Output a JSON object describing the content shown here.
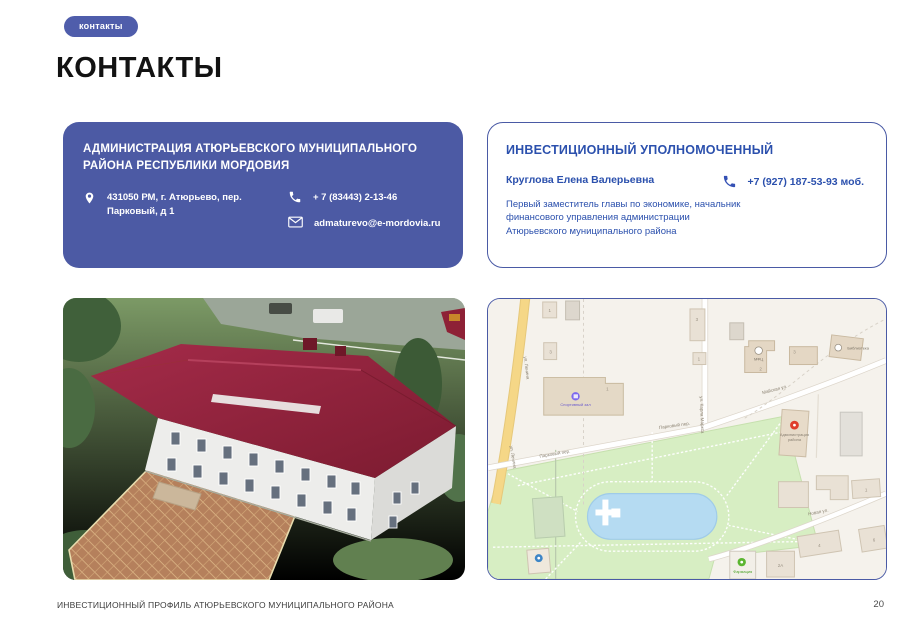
{
  "slide": {
    "badge_label": "контакты",
    "title": "КОНТАКТЫ",
    "footer_text": "ИНВЕСТИЦИОННЫЙ ПРОФИЛЬ АТЮРЬЕВСКОГО МУНИЦИПАЛЬНОГО РАЙОНА",
    "page_number": "20"
  },
  "admin_card": {
    "title": "АДМИНИСТРАЦИЯ АТЮРЬЕВСКОГО МУНИЦИПАЛЬНОГО РАЙОНА РЕСПУБЛИКИ МОРДОВИЯ",
    "address": "431050 РМ, г. Атюрьево, пер. Парковый, д 1",
    "phone": "+ 7 (83443) 2-13-46",
    "email": "admaturevo@e-mordovia.ru"
  },
  "investment_card": {
    "title": "ИНВЕСТИЦИОННЫЙ УПОЛНОМОЧЕННЫЙ",
    "name": "Круглова Елена Валерьевна",
    "phone": "+7 (927) 187-53-93 моб.",
    "position": "Первый заместитель главы по экономике, начальник финансового управления администрации Атюрьевского муниципального района"
  },
  "map": {
    "street_lenina": "ул. Ленина",
    "street_karla_marksa": "ул. Карла Маркса",
    "street_parkovy": "Парковый пер.",
    "street_mayskaya": "Майская ул.",
    "street_novaya": "Новая ул.",
    "poi_sport": "Спортивный зал",
    "poi_mfc": "МФЦ",
    "poi_library": "Библиотека",
    "poi_admin_line1": "Администрация",
    "poi_admin_line2": "района",
    "poi_pharmacy": "Фармация",
    "numbers": {
      "n1": "1",
      "n2": "2",
      "n3": "3",
      "n4": "4",
      "n6": "6",
      "n2a": "2А"
    }
  },
  "colors": {
    "accent_blue": "#4c5aa4",
    "text_blue": "#2b50ad",
    "roof_red": "#8e2136",
    "map_green": "#d7eec3",
    "pond_blue": "#b5dbf2",
    "road_yellow": "#f5d787"
  }
}
